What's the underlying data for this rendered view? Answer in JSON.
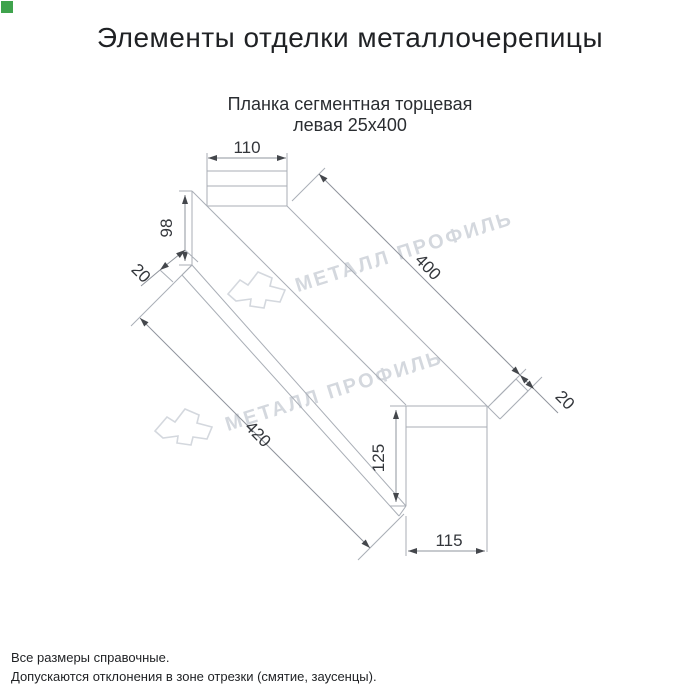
{
  "page": {
    "title": "Элементы отделки металлочерепицы",
    "subtitle_line1": "Планка сегментная торцевая",
    "subtitle_line2": "левая 25х400"
  },
  "drawing": {
    "dims": {
      "top_width": "110",
      "left_height": "98",
      "left_flange": "20",
      "face_length": "400",
      "total_length": "420",
      "right_height": "125",
      "bottom_width": "115",
      "right_flange": "20"
    }
  },
  "watermark": {
    "text": "МЕТАЛЛ ПРОФИЛЬ",
    "color": "#d4d8de"
  },
  "footer": {
    "line1": "Все размеры справочные.",
    "line2": "Допускаются отклонения в зоне отрезки (смятие, заусенцы)."
  },
  "colors": {
    "accent_square": "#3fa34d",
    "line": "#a9aeb6",
    "dim_text": "#33363b"
  }
}
